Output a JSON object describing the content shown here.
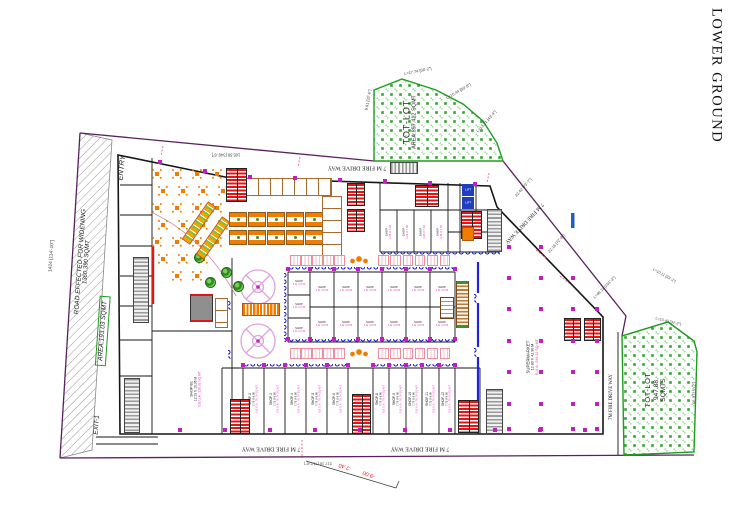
{
  "title": "LOWER GROUND",
  "colors": {
    "boundary": "#5A2160",
    "walls": "#161616",
    "green": "#1F9D1F",
    "stair_red": "#E11616",
    "furniture_orange": "#F07D00",
    "awning_blue": "#2222DD",
    "column_magenta": "#C21FC2",
    "label_pink": "#E935C1",
    "stall_tan": "#A9692F"
  },
  "annotations": {
    "entry": "ENTRY",
    "exit": "EXIT-1",
    "road_widening_line1": "ROAD EFFECTED FOR WIDENING",
    "road_widening_line2": "1360.390 SQMT",
    "area_box": "AREA:193.03 SQMT"
  },
  "levels": {
    "top": "-6.20",
    "bottom_a": "-7.40",
    "bottom_b": "-9.00"
  },
  "tot_lot_top": {
    "name": "TOT-LOT",
    "area": "AREA:897.412 SQMT"
  },
  "tot_lot_bottom": {
    "name": "TOT-LOT",
    "area": "947.88",
    "unit": "SQMTS"
  },
  "fire_drive_way": {
    "top": "7 M FIRE DRIVE WAY",
    "diagonal": "7 M FIRE DRIVE WAY",
    "bottom_left": "7 M FIRE DRIVE WAY",
    "bottom_right": "7 M FIRE DRIVE WAY",
    "right_vertical": "7M FIRE DRIVE WAY"
  },
  "supermarket": {
    "name": "SUPERMARKET",
    "dims": "12.80 X 42.90 M",
    "area": "B.U.A : 549.12 SQ MT"
  },
  "hall": {
    "name": "SHOP-B1",
    "dims": "12.19 X 10.36 M",
    "area": "S.B.U.A : 126.33 SQ MT"
  },
  "lift_label": "LIFT",
  "dimensions": {
    "left": "1424 [114'-10\"]",
    "top": "105.58 [346'-5\"]",
    "bottom": "217.16 [712'-6\"]",
    "right_lower": "46.3 [15'-2\"]",
    "diag_1": "L=17.74 [58'-2\"]",
    "diag_2": "L=15.44 [50'-8\"]",
    "diag_3": "L=13.21 [43'-4\"]",
    "diag_4": "22.42 [73'-7\"]",
    "diag_5": "22.16 [72'-8\"]",
    "diag_6": "L=46.11 [151'-3\"]",
    "green_left": "9.91 [32'-6\"]",
    "corner_1": "L=10.11 [33'-2\"]",
    "corner_2": "L=10.40 [34'-2\"]"
  },
  "bottom_shops": [
    {
      "name": "SHOP-2",
      "dims": "7.75 X 9.90",
      "area": "S.B.U.A : 76.74 SQ MT"
    },
    {
      "name": "SHOP-3",
      "dims": "7.75 X 9.90",
      "area": "S.B.U.A : 76.74 SQ MT"
    },
    {
      "name": "SHOP-4",
      "dims": "7.75 X 9.90",
      "area": "S.B.U.A : 76.74 SQ MT"
    },
    {
      "name": "SHOP-5",
      "dims": "7.75 X 9.90",
      "area": "S.B.U.A : 76.74 SQ MT"
    },
    {
      "name": "SHOP-6",
      "dims": "7.75 X 9.90",
      "area": "S.B.U.A : 76.74 SQ MT"
    },
    {
      "name": "SHOP-8",
      "dims": "7.75 X 9.90",
      "area": "S.B.U.A : 76.74 SQ MT"
    },
    {
      "name": "SHOP-9",
      "dims": "7.75 X 9.90",
      "area": "S.B.U.A : 76.74 SQ MT"
    },
    {
      "name": "SHOP-10",
      "dims": "7.75 X 9.90",
      "area": "S.B.U.A : 76.74 SQ MT"
    },
    {
      "name": "SHOP-11",
      "dims": "7.75 X 9.90",
      "area": "S.B.U.A : 76.74 SQ MT"
    },
    {
      "name": "SHOP-12",
      "dims": "7.75 X 9.90",
      "area": "S.B.U.A : 76.74 SQ MT"
    }
  ],
  "central_shops": {
    "name": "SHOP",
    "dims": "4.11 X 8.53"
  },
  "upper_shops": {
    "name": "SHOP",
    "dims": "4.26 X 7.92"
  }
}
